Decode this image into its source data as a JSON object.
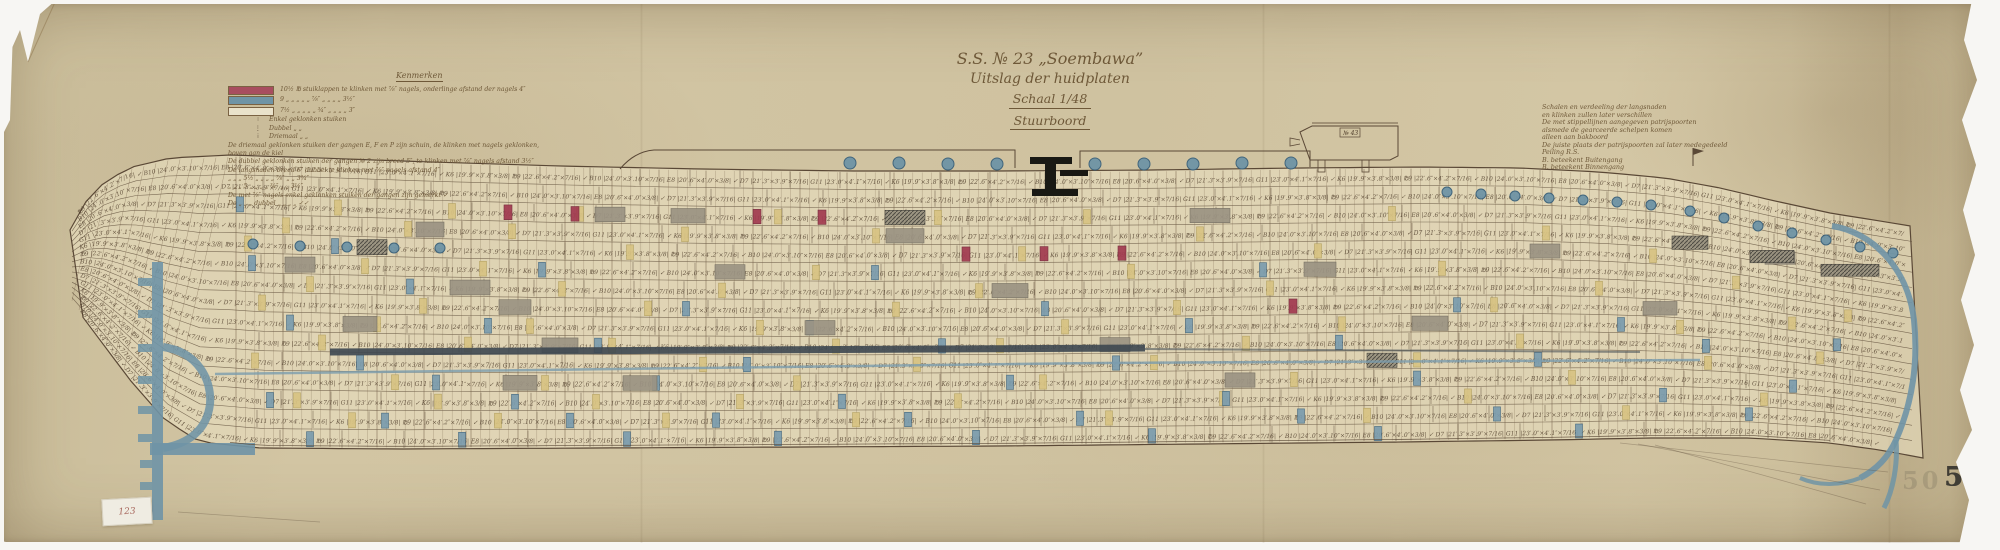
{
  "document": {
    "title_line1": "S.S. № 23 „Soembawa”",
    "title_line2": "Uitslag der huidplaten",
    "title_line3": "Schaal 1/48",
    "title_line4": "Stuurboord",
    "sheet_number": "50",
    "inventory_label": "123"
  },
  "legend": {
    "heading": "Kenmerken",
    "swatch_rows": [
      {
        "color": "#a84d5f",
        "text": "10½ ℔ stuiklappen te klinken met ⅞″ nagels, onderlinge afstand der nagels 4″"
      },
      {
        "color": "#6f94a6",
        "text": "9 „ „ „ „ „ ⅞″ „ „ „ „ 3½″"
      },
      {
        "color": "#e9e2cb",
        "text": "7½ „ „ „ „ „ ¾″ „ „ „ „ 3″"
      }
    ],
    "rivet_rows": [
      {
        "glyph": "∶",
        "text": "Enkel geklonken stuiken"
      },
      {
        "glyph": "⋮",
        "text": "Dubbel „ „"
      },
      {
        "glyph": "⁞",
        "text": "Driemaal „ „"
      }
    ],
    "notes": [
      "De driemaal geklonken stuiken der gangen E, F en P zijn schuin, de klinken met nagels geklonken,",
      "boven aan de kiel",
      "De dubbel geklonken stuiken der gangen № 2 zijn breed 5″, te klinken met ⅞″ nagels afstand 3½″",
      "De langsnaden breed 6″ dubbel te klinken met ⅞″ nagels afstand 4″",
      "„ „ „ 5½ „ „ „ „ ⅞″ „ „ 3¾″",
      "„ „ „ 5 „ „ „ „ ¾″ „ „ 3½″",
      "De met ⅞″ nagels enkel geklonken stuiken der gangen zijn gemerkt ✓",
      "De „ „ „ dubbel „ „ „ „ ✓✓"
    ]
  },
  "notes_right": {
    "lines": [
      "Schalen en verdeeling der langsnaden",
      "en klinken zullen later verschillen",
      "De met stippellijnen aangegeven patrijspoorten",
      "alsmede de gearceerde schelpen komen",
      "alleen aan bakboord",
      "De juiste plaats der patrijspoorten zal later medegedeeld",
      "Peiling R.S.",
      "B. beteekent Buitengang",
      "B. beteekent Binnengang"
    ]
  },
  "drawing": {
    "inset_label": "№ 43",
    "plate_labels": [
      "℔9 |22′.6″×4′.2″×7/16| ✓",
      "B10 |24′.0″×3′.10″×7/16|",
      "E8 |20′.6″×4′.0″×3/8| ✓",
      "D7 |21′.3″×3′.9″×7/16|",
      "G11 |23′.0″×4′.1″×7/16| ✓",
      "K6 |19′.9″×3′.8″×3/8|"
    ],
    "hull": {
      "strakes": 15,
      "top": [
        [
          70,
          230
        ],
        [
          82,
          206
        ],
        [
          100,
          186
        ],
        [
          128,
          168
        ],
        [
          170,
          158
        ],
        [
          230,
          155
        ],
        [
          320,
          158
        ],
        [
          430,
          162
        ],
        [
          560,
          166
        ],
        [
          700,
          169
        ],
        [
          850,
          171
        ],
        [
          1000,
          171
        ],
        [
          1150,
          170
        ],
        [
          1300,
          168
        ],
        [
          1420,
          167
        ],
        [
          1520,
          168
        ],
        [
          1600,
          172
        ],
        [
          1665,
          178
        ],
        [
          1720,
          188
        ],
        [
          1775,
          201
        ],
        [
          1830,
          213
        ],
        [
          1880,
          221
        ],
        [
          1923,
          228
        ]
      ],
      "bot": [
        [
          70,
          300
        ],
        [
          100,
          340
        ],
        [
          130,
          380
        ],
        [
          165,
          420
        ],
        [
          200,
          442
        ],
        [
          260,
          448
        ],
        [
          400,
          449
        ],
        [
          600,
          448
        ],
        [
          800,
          447
        ],
        [
          1000,
          446
        ],
        [
          1200,
          444
        ],
        [
          1400,
          442
        ],
        [
          1550,
          440
        ],
        [
          1650,
          438
        ],
        [
          1750,
          438
        ],
        [
          1830,
          443
        ],
        [
          1880,
          450
        ],
        [
          1923,
          458
        ]
      ]
    },
    "frames": {
      "x0": 236,
      "x1": 1876,
      "step": 9.4
    },
    "rails": [
      "M620,169 C630,157 641,151 654,150 L1015,150 L1015,168",
      "M1080,168 L1080,151 L1310,151 L1310,167"
    ],
    "bars": {
      "yellow": [
        [
          248,
          4
        ],
        [
          262,
          7
        ],
        [
          255,
          10
        ],
        [
          286,
          3
        ],
        [
          297,
          12
        ],
        [
          310,
          6
        ],
        [
          322,
          9
        ],
        [
          338,
          2
        ],
        [
          352,
          13
        ],
        [
          365,
          5
        ],
        [
          377,
          8
        ],
        [
          395,
          11
        ],
        [
          408,
          3
        ],
        [
          423,
          7
        ],
        [
          438,
          12
        ],
        [
          452,
          2
        ],
        [
          468,
          9
        ],
        [
          483,
          5
        ],
        [
          498,
          13
        ],
        [
          512,
          3
        ],
        [
          530,
          8
        ],
        [
          545,
          11
        ],
        [
          562,
          6
        ],
        [
          580,
          2
        ],
        [
          596,
          12
        ],
        [
          612,
          9
        ],
        [
          630,
          4
        ],
        [
          648,
          7
        ],
        [
          666,
          13
        ],
        [
          685,
          3
        ],
        [
          703,
          10
        ],
        [
          722,
          6
        ],
        [
          740,
          12
        ],
        [
          760,
          8
        ],
        [
          778,
          2
        ],
        [
          797,
          11
        ],
        [
          816,
          5
        ],
        [
          836,
          9
        ],
        [
          856,
          13
        ],
        [
          876,
          3
        ],
        [
          896,
          7
        ],
        [
          917,
          10
        ],
        [
          938,
          2
        ],
        [
          958,
          12
        ],
        [
          979,
          6
        ],
        [
          1000,
          9
        ],
        [
          1022,
          4
        ],
        [
          1043,
          11
        ],
        [
          1065,
          8
        ],
        [
          1087,
          2
        ],
        [
          1109,
          13
        ],
        [
          1131,
          5
        ],
        [
          1154,
          10
        ],
        [
          1177,
          7
        ],
        [
          1200,
          3
        ],
        [
          1223,
          12
        ],
        [
          1246,
          9
        ],
        [
          1270,
          6
        ],
        [
          1294,
          11
        ],
        [
          1318,
          4
        ],
        [
          1342,
          8
        ],
        [
          1367,
          13
        ],
        [
          1392,
          2
        ],
        [
          1417,
          10
        ],
        [
          1442,
          5
        ],
        [
          1468,
          12
        ],
        [
          1494,
          7
        ],
        [
          1520,
          9
        ],
        [
          1546,
          3
        ],
        [
          1572,
          11
        ],
        [
          1599,
          6
        ],
        [
          1626,
          13
        ],
        [
          1653,
          4
        ],
        [
          1680,
          8
        ],
        [
          1708,
          10
        ],
        [
          1736,
          5
        ],
        [
          1764,
          12
        ],
        [
          1792,
          7
        ],
        [
          1820,
          9
        ],
        [
          1848,
          6
        ]
      ],
      "blue": [
        [
          240,
          2
        ],
        [
          252,
          5
        ],
        [
          270,
          12
        ],
        [
          290,
          8
        ],
        [
          310,
          14
        ],
        [
          335,
          4
        ],
        [
          360,
          10
        ],
        [
          385,
          13
        ],
        [
          410,
          6
        ],
        [
          436,
          11
        ],
        [
          462,
          14
        ],
        [
          488,
          8
        ],
        [
          515,
          12
        ],
        [
          542,
          5
        ],
        [
          570,
          13
        ],
        [
          598,
          9
        ],
        [
          627,
          14
        ],
        [
          656,
          11
        ],
        [
          686,
          7
        ],
        [
          716,
          13
        ],
        [
          747,
          10
        ],
        [
          778,
          14
        ],
        [
          810,
          8
        ],
        [
          842,
          12
        ],
        [
          875,
          5
        ],
        [
          908,
          13
        ],
        [
          942,
          9
        ],
        [
          976,
          14
        ],
        [
          1010,
          11
        ],
        [
          1045,
          7
        ],
        [
          1080,
          13
        ],
        [
          1116,
          10
        ],
        [
          1152,
          14
        ],
        [
          1189,
          8
        ],
        [
          1226,
          12
        ],
        [
          1263,
          5
        ],
        [
          1301,
          13
        ],
        [
          1339,
          9
        ],
        [
          1378,
          14
        ],
        [
          1417,
          11
        ],
        [
          1457,
          7
        ],
        [
          1497,
          13
        ],
        [
          1538,
          10
        ],
        [
          1579,
          14
        ],
        [
          1621,
          8
        ],
        [
          1663,
          12
        ],
        [
          1706,
          9
        ],
        [
          1749,
          13
        ],
        [
          1793,
          11
        ],
        [
          1837,
          8
        ]
      ],
      "red": [
        [
          508,
          2
        ],
        [
          575,
          2
        ],
        [
          757,
          2
        ],
        [
          822,
          2
        ],
        [
          966,
          4
        ],
        [
          1044,
          4
        ],
        [
          1122,
          4
        ],
        [
          1293,
          7
        ]
      ]
    },
    "plates": {
      "gray": [
        [
          300,
          5,
          30
        ],
        [
          360,
          8,
          34
        ],
        [
          430,
          3,
          28
        ],
        [
          470,
          6,
          40
        ],
        [
          515,
          7,
          32
        ],
        [
          560,
          9,
          36
        ],
        [
          610,
          2,
          30
        ],
        [
          688,
          2,
          34
        ],
        [
          905,
          3,
          38
        ],
        [
          730,
          5,
          30
        ],
        [
          640,
          11,
          34
        ],
        [
          820,
          8,
          30
        ],
        [
          1010,
          6,
          36
        ],
        [
          1115,
          9,
          30
        ],
        [
          1210,
          2,
          40
        ],
        [
          1320,
          5,
          32
        ],
        [
          1430,
          8,
          36
        ],
        [
          1545,
          4,
          30
        ],
        [
          1660,
          7,
          34
        ],
        [
          1780,
          3,
          30
        ],
        [
          520,
          11,
          34
        ],
        [
          1240,
          11,
          30
        ]
      ],
      "dark": [
        [
          905,
          2,
          40
        ],
        [
          1382,
          10,
          30
        ],
        [
          1690,
          3,
          36
        ],
        [
          1772,
          3,
          44
        ],
        [
          372,
          4,
          30
        ],
        [
          1850,
          3,
          58
        ]
      ]
    },
    "portholes": [
      [
        850,
        163,
        6
      ],
      [
        899,
        163,
        6
      ],
      [
        948,
        164,
        6
      ],
      [
        997,
        164,
        6
      ],
      [
        1095,
        164,
        6
      ],
      [
        1144,
        164,
        6
      ],
      [
        1193,
        164,
        6
      ],
      [
        1242,
        163,
        6
      ],
      [
        1291,
        163,
        6
      ],
      [
        253,
        244,
        5
      ],
      [
        300,
        246,
        5
      ],
      [
        347,
        247,
        5
      ],
      [
        394,
        248,
        5
      ],
      [
        440,
        248,
        5
      ],
      [
        1447,
        192,
        5
      ],
      [
        1481,
        194,
        5
      ],
      [
        1515,
        196,
        5
      ],
      [
        1549,
        198,
        5
      ],
      [
        1583,
        200,
        5
      ],
      [
        1617,
        202,
        5
      ],
      [
        1651,
        205,
        5
      ],
      [
        1690,
        211,
        5
      ],
      [
        1724,
        218,
        5
      ],
      [
        1758,
        226,
        5
      ],
      [
        1792,
        233,
        5
      ],
      [
        1826,
        240,
        5
      ],
      [
        1860,
        247,
        5
      ],
      [
        1893,
        253,
        5
      ]
    ],
    "fitting": [
      [
        1030,
        157,
        42,
        7
      ],
      [
        1045,
        157,
        11,
        38
      ],
      [
        1032,
        189,
        46,
        7
      ],
      [
        1060,
        170,
        28,
        6
      ]
    ],
    "stem": {
      "bar": [
        152,
        262,
        11,
        258
      ],
      "loop": "M163,347 C198,352 212,380 210,404 C207,430 188,444 163,448",
      "foot": [
        150,
        443,
        105,
        12
      ],
      "nibs": [
        [
          138,
          278,
          14,
          8
        ],
        [
          138,
          310,
          14,
          8
        ],
        [
          138,
          344,
          14,
          8
        ],
        [
          138,
          376,
          14,
          8
        ],
        [
          138,
          406,
          14,
          8
        ],
        [
          138,
          434,
          14,
          8
        ],
        [
          140,
          460,
          12,
          8
        ],
        [
          140,
          482,
          12,
          8
        ]
      ]
    },
    "stern": {
      "main": "M1832,226 C1872,232 1908,268 1914,320 C1919,368 1910,408 1896,440 C1888,458 1876,470 1860,478",
      "branchA": "M1896,440 C1898,465 1893,490 1884,508",
      "branchB": "M1860,478 C1840,486 1818,486 1800,478"
    },
    "bilge": {
      "band": "M330,352 L1145,348",
      "band2": "M1145,349 L1640,352",
      "blueline": "M215,374 Q700,366 1100,363 T1700,360"
    },
    "colors": {
      "ink": "#5a4836",
      "frame": "#77624a",
      "text": "#4a3826",
      "yellow": "#d8c383",
      "yellowEdge": "#b3a05e",
      "blue": "#7b9cae",
      "blueDark": "#39607a",
      "red": "#a23a50",
      "gray": "#9b9383",
      "hatchBg": "#98917f",
      "hatchLine": "#44423c",
      "sea": "#6f94a6",
      "band": "#3d4750",
      "black": "#191914",
      "fill": "#e9dfc2"
    }
  }
}
